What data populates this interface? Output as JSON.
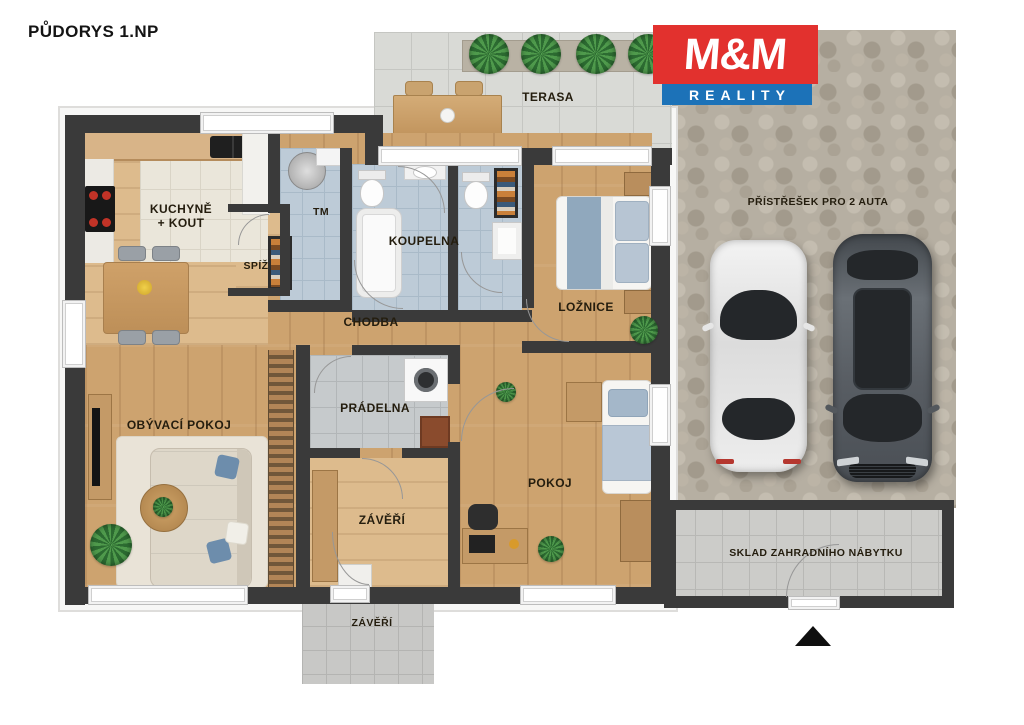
{
  "title": "PŮDORYS 1.NP",
  "logo": {
    "top": "M&M",
    "bottom": "REALITY"
  },
  "labels": {
    "kitchen_l1": "KUCHYNĚ",
    "kitchen_l2": "+ KOUT",
    "pantry": "SPÍŽ",
    "utility": "TM",
    "bathroom": "KOUPELNA",
    "hallway": "CHODBA",
    "bedroom": "LOŽNICE",
    "living": "OBÝVACÍ POKOJ",
    "laundry": "PRÁDELNA",
    "vestibule": "ZÁVĚŘÍ",
    "room": "POKOJ",
    "terrace": "TERASA",
    "carport": "PŘÍSTŘEŠEK PRO 2 AUTA",
    "shed": "SKLAD ZAHRADNÍHO NÁBYTKU",
    "porch": "ZÁVĚŘÍ"
  },
  "colors": {
    "logo_red": "#e2312e",
    "logo_blue": "#1c72b8",
    "wall": "#3a3a3a",
    "wood_floor": "#cda36f",
    "bath_tile": "#bdcbd7",
    "stone_paving": "#b6afa2"
  }
}
